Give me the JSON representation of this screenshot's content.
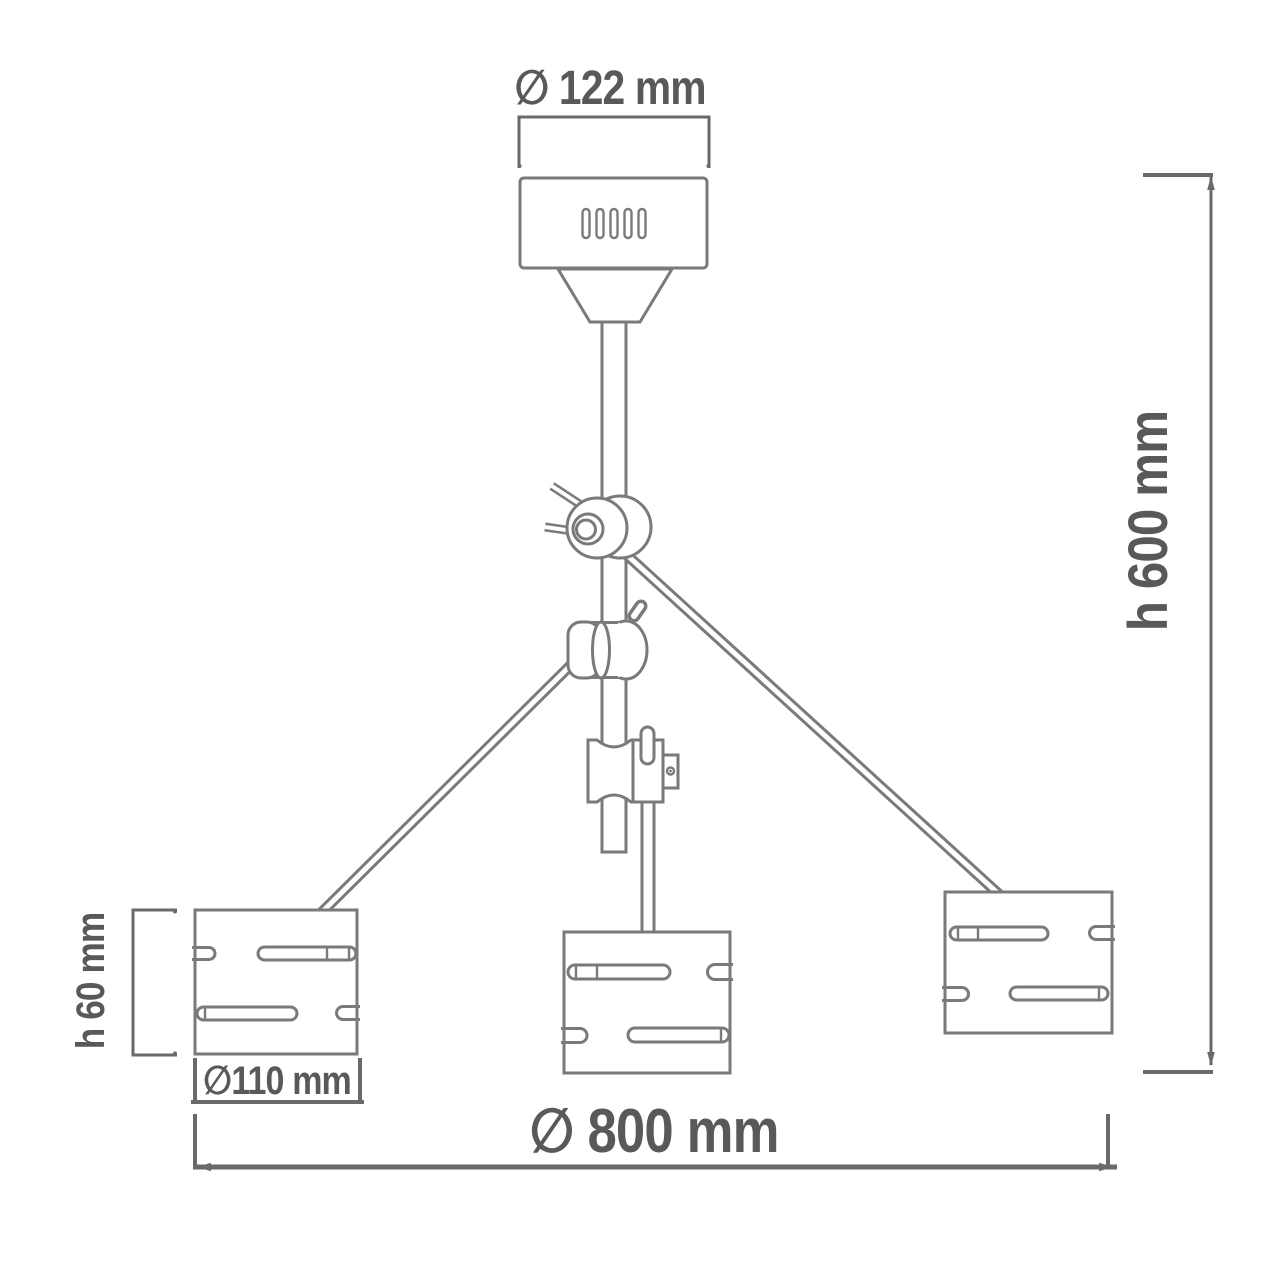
{
  "diagram": {
    "kind": "technical dimensional drawing",
    "subject": "three-arm adjustable ceiling lamp"
  },
  "labels": {
    "canopy_diameter": "∅ 122 mm",
    "overall_height": "h 600 mm",
    "shade_height": "h 60 mm",
    "shade_diameter": "∅110 mm",
    "overall_width": "∅ 800 mm"
  },
  "colors": {
    "background": "#ffffff",
    "outline": "#797a7c",
    "dimension": "#696a6c",
    "text": "#58595b"
  }
}
